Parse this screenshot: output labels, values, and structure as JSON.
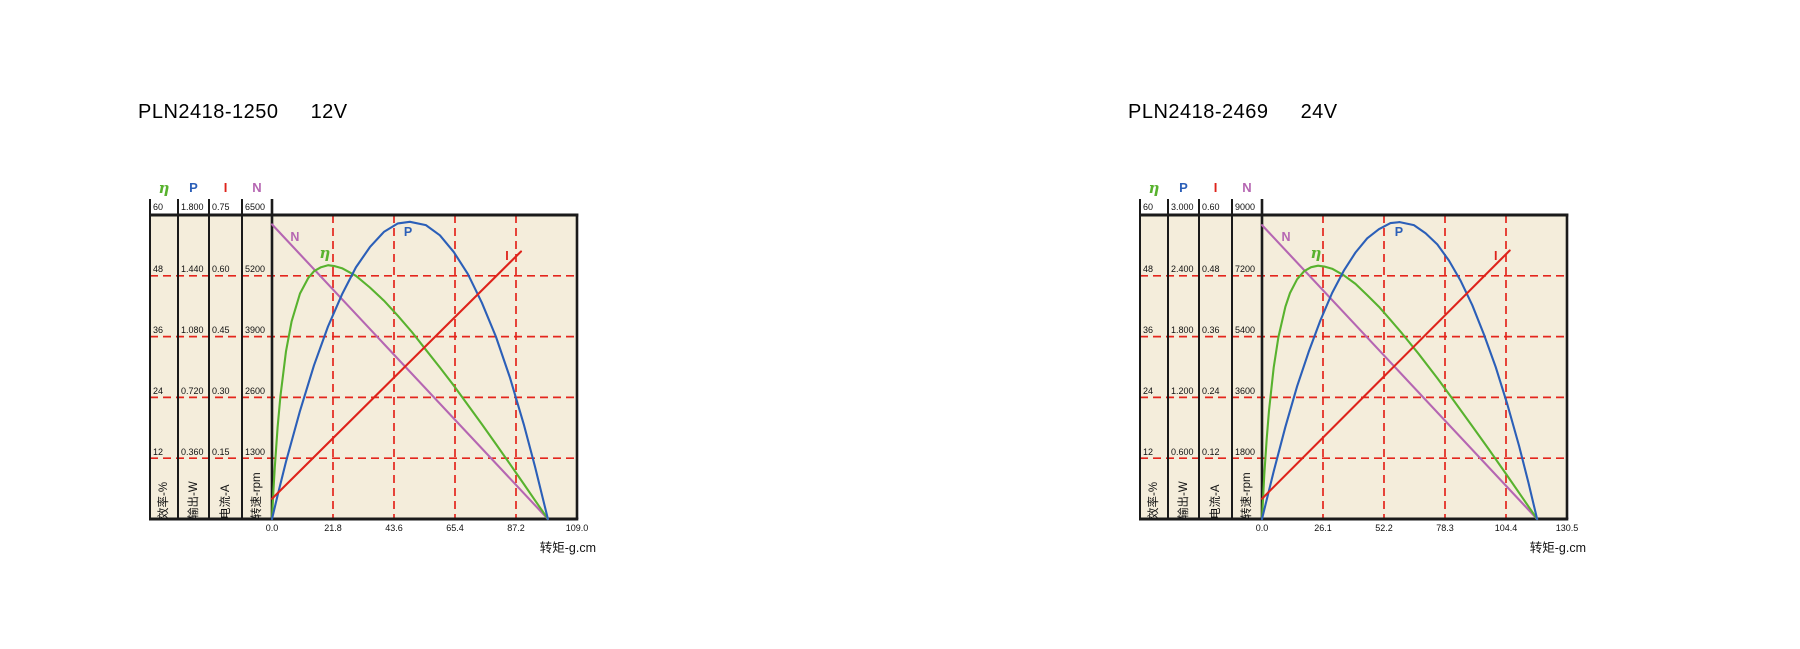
{
  "page": {
    "background": "#ffffff"
  },
  "chart_data": [
    {
      "type": "line",
      "title": {
        "model": "PLN2418-1250",
        "voltage": "12V"
      },
      "x_axis": {
        "label": "转矩-g.cm",
        "min": 0,
        "max": 109.0,
        "tick_labels": [
          "0.0",
          "21.8",
          "43.6",
          "65.4",
          "87.2",
          "109.0"
        ]
      },
      "style": {
        "plot_bg": "#f4eddb",
        "grid_color": "#e3261d",
        "frame_color": "#1a1a1a"
      },
      "y_axes": [
        {
          "id": "eta",
          "legend": "η",
          "axis_label": "效率-%",
          "color": "#58b22e",
          "max": 60,
          "tick_labels": [
            "60",
            "48",
            "36",
            "24",
            "12"
          ]
        },
        {
          "id": "P",
          "legend": "P",
          "axis_label": "输出-W",
          "color": "#2b5fb8",
          "max": 1.8,
          "tick_labels": [
            "1.800",
            "1.440",
            "1.080",
            "0.720",
            "0.360"
          ]
        },
        {
          "id": "I",
          "legend": "I",
          "axis_label": "电流-A",
          "color": "#de231b",
          "max": 0.75,
          "tick_labels": [
            "0.75",
            "0.60",
            "0.45",
            "0.30",
            "0.15"
          ]
        },
        {
          "id": "N",
          "legend": "N",
          "axis_label": "转速-rpm",
          "color": "#b566b2",
          "max": 6500,
          "tick_labels": [
            "6500",
            "5200",
            "3900",
            "2600",
            "1300"
          ]
        }
      ],
      "series": [
        {
          "name": "speed",
          "axis": "N",
          "color": "#b566b2",
          "label": {
            "text": "N",
            "at": [
              8.2,
              6030
            ]
          },
          "points": [
            [
              0,
              6300
            ],
            [
              98.6,
              0
            ]
          ]
        },
        {
          "name": "efficiency",
          "axis": "eta",
          "color": "#58b22e",
          "label": {
            "text": "η",
            "at": [
              18.9,
              52.5
            ]
          },
          "points": [
            [
              0,
              0
            ],
            [
              0.5,
              5.5
            ],
            [
              1,
              10.2
            ],
            [
              2,
              18.1
            ],
            [
              3,
              24.2
            ],
            [
              5,
              33.1
            ],
            [
              7,
              39
            ],
            [
              10,
              44.5
            ],
            [
              13,
              47.6
            ],
            [
              15,
              48.9
            ],
            [
              17.5,
              49.7
            ],
            [
              20,
              50.1
            ],
            [
              22.5,
              49.9
            ],
            [
              25,
              49.5
            ],
            [
              30,
              48
            ],
            [
              35,
              45.7
            ],
            [
              40,
              43.1
            ],
            [
              45,
              40.1
            ],
            [
              50,
              36.9
            ],
            [
              55,
              33.4
            ],
            [
              60,
              29.9
            ],
            [
              65,
              26.3
            ],
            [
              70,
              22.5
            ],
            [
              75,
              18.7
            ],
            [
              80,
              14.8
            ],
            [
              85,
              10.9
            ],
            [
              90,
              6.9
            ],
            [
              94,
              3.7
            ],
            [
              98.6,
              0
            ]
          ]
        },
        {
          "name": "output-power",
          "axis": "P",
          "color": "#2b5fb8",
          "label": {
            "text": "P",
            "at": [
              48.6,
              1.7
            ]
          },
          "points": [
            [
              0,
              0
            ],
            [
              2,
              0.14
            ],
            [
              5,
              0.34
            ],
            [
              10,
              0.64
            ],
            [
              15,
              0.91
            ],
            [
              20,
              1.14
            ],
            [
              25,
              1.33
            ],
            [
              30,
              1.49
            ],
            [
              35,
              1.61
            ],
            [
              40,
              1.7
            ],
            [
              45,
              1.75
            ],
            [
              49.3,
              1.76
            ],
            [
              55,
              1.74
            ],
            [
              60,
              1.68
            ],
            [
              65,
              1.58
            ],
            [
              70,
              1.45
            ],
            [
              75,
              1.28
            ],
            [
              80,
              1.08
            ],
            [
              85,
              0.84
            ],
            [
              90,
              0.56
            ],
            [
              94,
              0.31
            ],
            [
              98.6,
              0
            ]
          ]
        },
        {
          "name": "current",
          "axis": "I",
          "color": "#de231b",
          "label": {
            "text": "I",
            "at": [
              84,
              0.65
            ]
          },
          "points": [
            [
              0,
              0.05
            ],
            [
              89,
              0.66
            ]
          ]
        }
      ]
    },
    {
      "type": "line",
      "title": {
        "model": "PLN2418-2469",
        "voltage": "24V"
      },
      "x_axis": {
        "label": "转矩-g.cm",
        "min": 0,
        "max": 130.5,
        "tick_labels": [
          "0.0",
          "26.1",
          "52.2",
          "78.3",
          "104.4",
          "130.5"
        ]
      },
      "style": {
        "plot_bg": "#f4eddb",
        "grid_color": "#e3261d",
        "frame_color": "#1a1a1a"
      },
      "y_axes": [
        {
          "id": "eta",
          "legend": "η",
          "axis_label": "效率-%",
          "color": "#58b22e",
          "max": 60,
          "tick_labels": [
            "60",
            "48",
            "36",
            "24",
            "12"
          ]
        },
        {
          "id": "P",
          "legend": "P",
          "axis_label": "输出-W",
          "color": "#2b5fb8",
          "max": 3.0,
          "tick_labels": [
            "3.000",
            "2.400",
            "1.800",
            "1.200",
            "0.600"
          ]
        },
        {
          "id": "I",
          "legend": "I",
          "axis_label": "电流-A",
          "color": "#de231b",
          "max": 0.6,
          "tick_labels": [
            "0.60",
            "0.48",
            "0.36",
            "0.24",
            "0.12"
          ]
        },
        {
          "id": "N",
          "legend": "N",
          "axis_label": "转速-rpm",
          "color": "#b566b2",
          "max": 9000,
          "tick_labels": [
            "9000",
            "7200",
            "5400",
            "3600",
            "1800"
          ]
        }
      ],
      "series": [
        {
          "name": "speed",
          "axis": "N",
          "color": "#b566b2",
          "label": {
            "text": "N",
            "at": [
              10.3,
              8350
            ]
          },
          "points": [
            [
              0,
              8700
            ],
            [
              117.7,
              0
            ]
          ]
        },
        {
          "name": "efficiency",
          "axis": "eta",
          "color": "#58b22e",
          "label": {
            "text": "η",
            "at": [
              23.1,
              52.5
            ]
          },
          "points": [
            [
              0,
              0
            ],
            [
              0.5,
              4.6
            ],
            [
              1,
              8.8
            ],
            [
              2,
              15.8
            ],
            [
              3,
              21.4
            ],
            [
              5,
              29.9
            ],
            [
              7,
              35.9
            ],
            [
              10,
              41.9
            ],
            [
              12,
              44.6
            ],
            [
              15,
              47.3
            ],
            [
              18,
              48.9
            ],
            [
              21,
              49.7
            ],
            [
              24,
              50
            ],
            [
              27,
              49.8
            ],
            [
              30,
              49.4
            ],
            [
              35,
              48.1
            ],
            [
              40,
              46.4
            ],
            [
              45,
              44.2
            ],
            [
              50,
              41.9
            ],
            [
              55,
              39.3
            ],
            [
              60,
              36.6
            ],
            [
              67,
              32.6
            ],
            [
              75,
              27.8
            ],
            [
              82,
              23.4
            ],
            [
              90,
              18.3
            ],
            [
              97,
              13.8
            ],
            [
              105,
              8.5
            ],
            [
              111,
              4.5
            ],
            [
              117.7,
              0
            ]
          ]
        },
        {
          "name": "output-power",
          "axis": "P",
          "color": "#2b5fb8",
          "label": {
            "text": "P",
            "at": [
              58.6,
              2.83
            ]
          },
          "points": [
            [
              0,
              0
            ],
            [
              2,
              0.19
            ],
            [
              5,
              0.47
            ],
            [
              10,
              0.91
            ],
            [
              15,
              1.31
            ],
            [
              20,
              1.65
            ],
            [
              25,
              1.96
            ],
            [
              30,
              2.23
            ],
            [
              35,
              2.45
            ],
            [
              40,
              2.63
            ],
            [
              45,
              2.77
            ],
            [
              50,
              2.86
            ],
            [
              55,
              2.92
            ],
            [
              58.9,
              2.93
            ],
            [
              65,
              2.9
            ],
            [
              70,
              2.82
            ],
            [
              75,
              2.71
            ],
            [
              80,
              2.55
            ],
            [
              85,
              2.35
            ],
            [
              90,
              2.11
            ],
            [
              95,
              1.82
            ],
            [
              100,
              1.5
            ],
            [
              105,
              1.13
            ],
            [
              110,
              0.72
            ],
            [
              114,
              0.36
            ],
            [
              117.7,
              0
            ]
          ]
        },
        {
          "name": "current",
          "axis": "I",
          "color": "#de231b",
          "label": {
            "text": "I",
            "at": [
              100,
              0.52
            ]
          },
          "points": [
            [
              0,
              0.04
            ],
            [
              106,
              0.53
            ]
          ]
        }
      ]
    }
  ]
}
